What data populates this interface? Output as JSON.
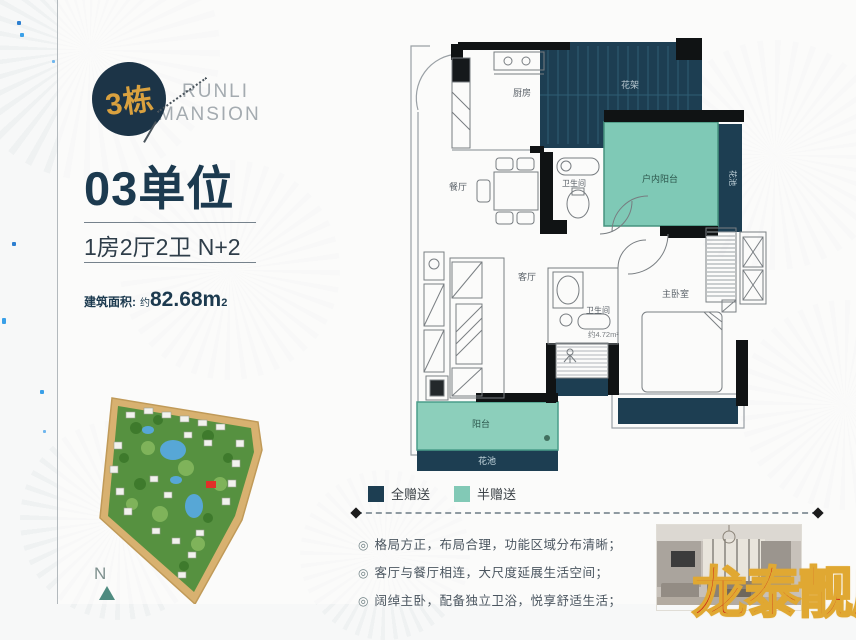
{
  "header": {
    "building_badge": "3栋",
    "brand_line1": "RUNLI",
    "brand_line2": "MANSION",
    "unit_title": "03单位",
    "unit_layout": "1房2厅2卫 N+2",
    "area_label": "建筑面积:",
    "area_prefix": "约",
    "area_value": "82.68m",
    "area_sup": "2"
  },
  "floorplan": {
    "rooms": {
      "kitchen": "厨房",
      "flower_rack": "花架",
      "dining_room": "餐厅",
      "bathroom_top": "卫生间",
      "indoor_balcony": "户内阳台",
      "flower_pool_side": "花池",
      "living_room": "客厅",
      "bathroom_master": "卫生间",
      "bathroom_master_area": "约4.72m²",
      "master_bedroom": "主卧室",
      "balcony": "阳台",
      "flower_pool_bottom": "花池"
    },
    "legend": [
      {
        "label": "全赠送",
        "color": "#1d3e52"
      },
      {
        "label": "半赠送",
        "color": "#82c9b6"
      }
    ]
  },
  "site_plan": {
    "compass_label": "N"
  },
  "features": {
    "marker": "◎",
    "items": [
      "格局方正，布局合理，功能区域分布清晰；",
      "客厅与餐厅相连，大尺度延展生活空间；",
      "阔绰主卧，配备独立卫浴，悦享舒适生活；"
    ]
  },
  "watermark": {
    "text": "龙泰靓房",
    "color": "#cd2418",
    "outline_color": "#e0a832"
  },
  "colors": {
    "navy": "#1d3e52",
    "teal": "#82c9b6",
    "gold": "#d9a13f"
  }
}
